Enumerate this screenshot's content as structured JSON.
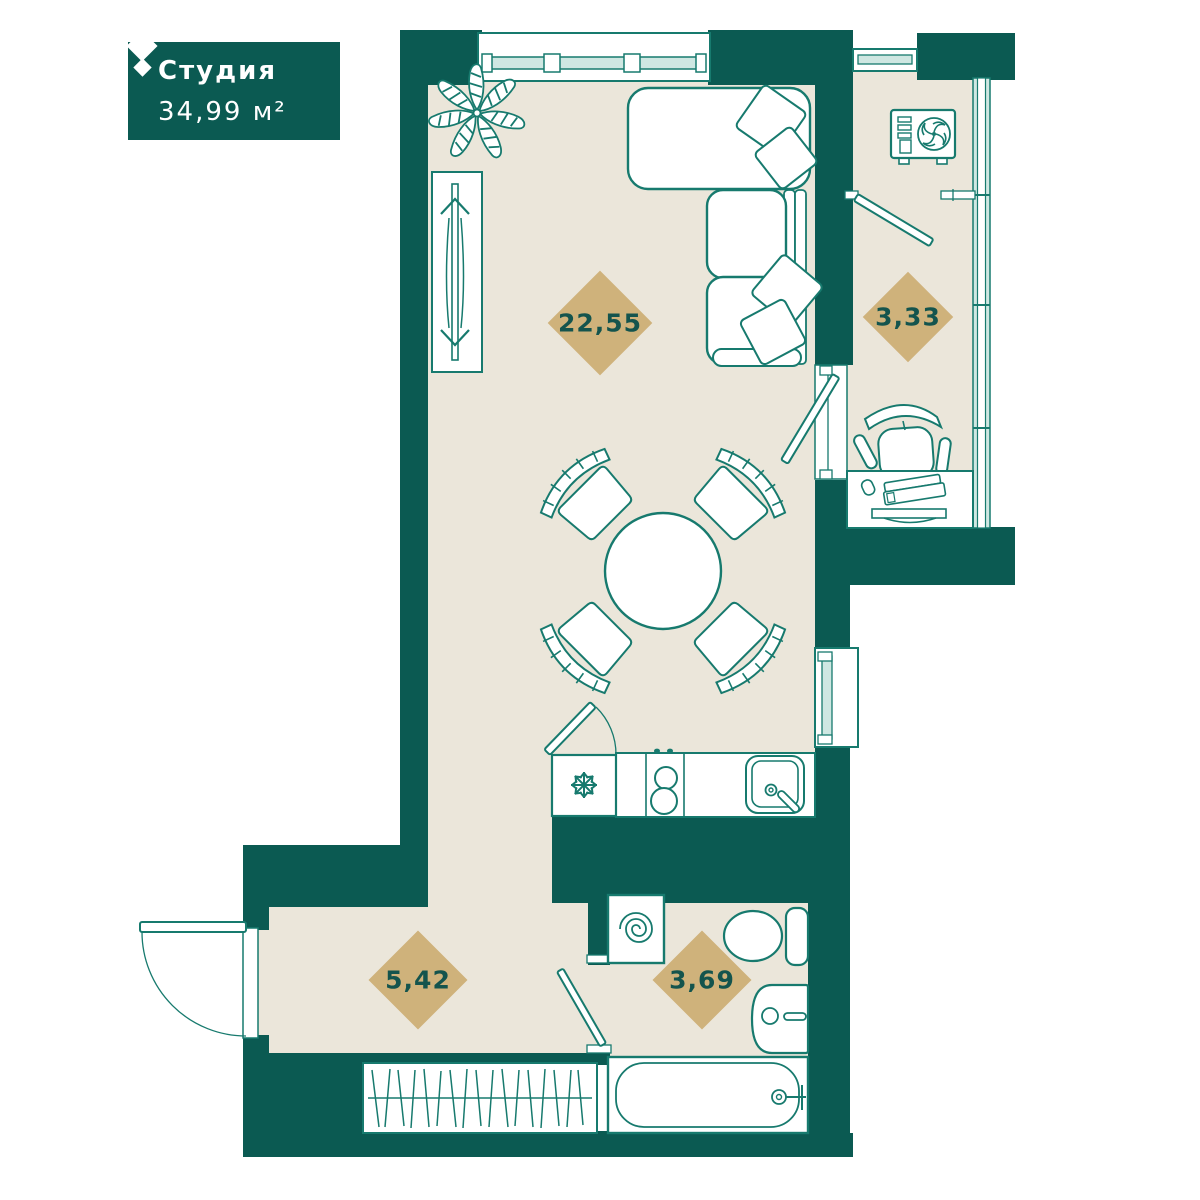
{
  "header": {
    "unit_type": "Студия",
    "total_area": "34,99 м²"
  },
  "rooms": {
    "living": {
      "area": "22,55"
    },
    "balcony": {
      "area": "3,33"
    },
    "hallway": {
      "area": "5,42"
    },
    "bathroom": {
      "area": "3,69"
    }
  },
  "icons": {
    "brand_logo": "double-diamond",
    "fridge": "snowflake",
    "washing_machine": "spiral-drum",
    "air_conditioner": "fan-unit"
  },
  "colors": {
    "wall": "#0b5a52",
    "floor": "#ebe6da",
    "line": "#177a6e",
    "area_diamond": "#cfb27b",
    "area_text": "#14544d",
    "glazing": "#cfe7e2"
  }
}
